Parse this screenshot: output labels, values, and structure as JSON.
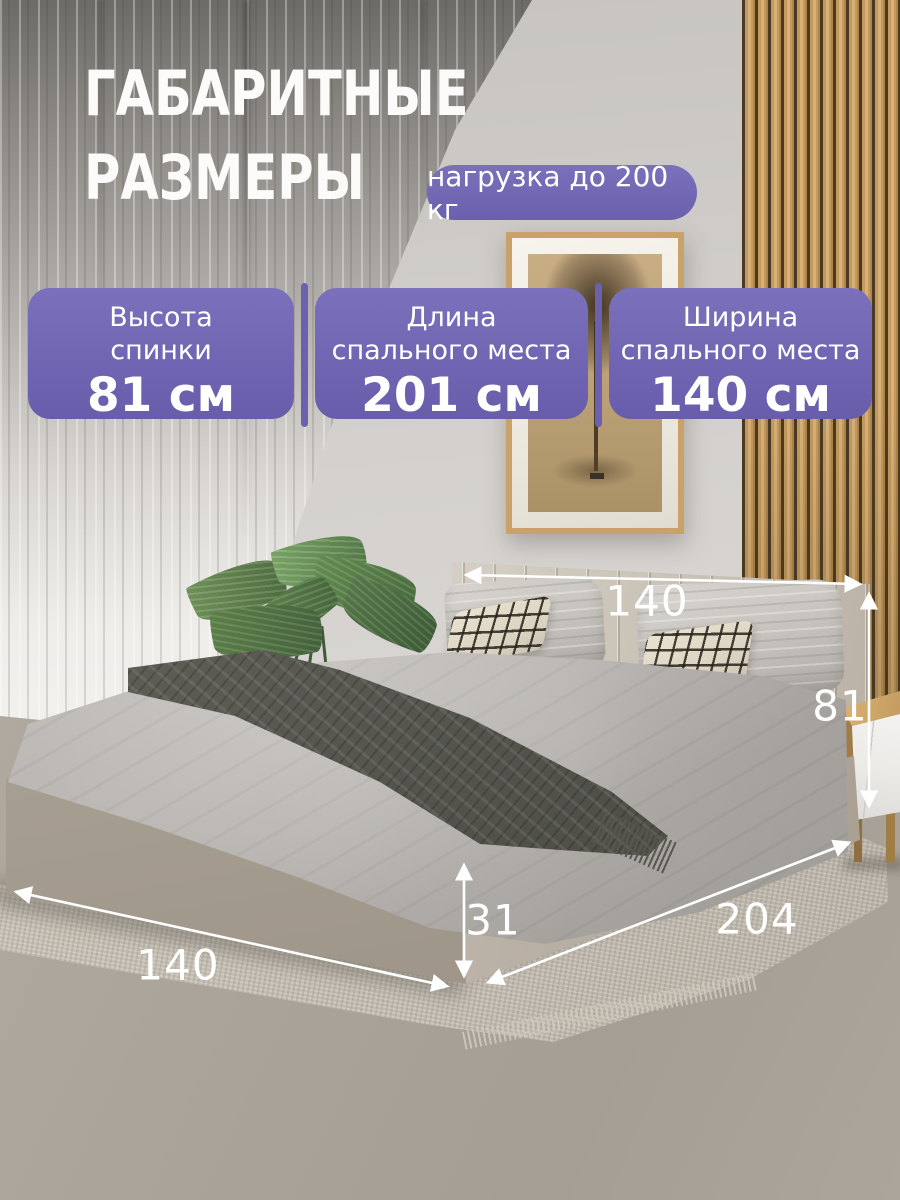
{
  "header": {
    "title_line1": "ГАБАРИТНЫЕ",
    "title_line2": "РАЗМЕРЫ",
    "badge": "нагрузка до 200 кг"
  },
  "spec_cards": [
    {
      "label_line1": "Высота",
      "label_line2": "спинки",
      "value": "81 см"
    },
    {
      "label_line1": "Длина",
      "label_line2": "спального места",
      "value": "201 см"
    },
    {
      "label_line1": "Ширина",
      "label_line2": "спального места",
      "value": "140 см"
    }
  ],
  "photo_annotations": {
    "bed_width_top": "140",
    "headboard_height": "81",
    "frame_height": "31",
    "bed_length": "204",
    "bed_width_front": "140"
  },
  "colors": {
    "accent_purple": "#6b61ae",
    "text_white": "#ffffff"
  }
}
